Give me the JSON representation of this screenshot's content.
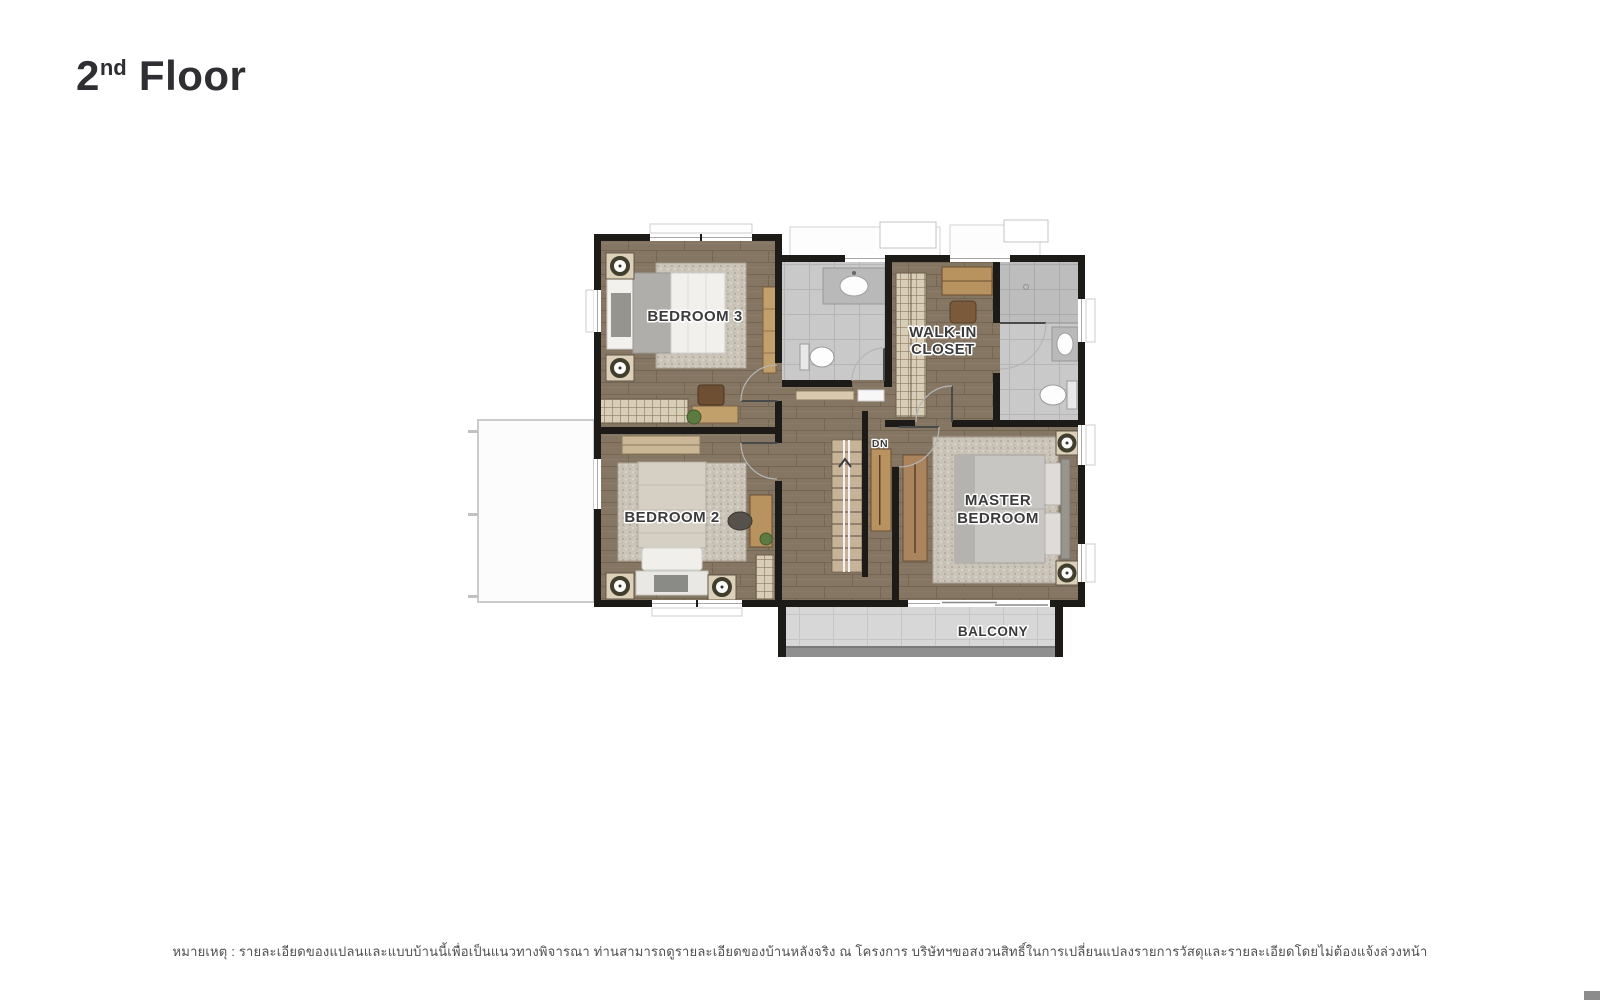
{
  "title": {
    "number": "2",
    "ordinal": "nd",
    "word": "Floor"
  },
  "disclaimer": "หมายเหตุ : รายละเอียดของแปลนและแบบบ้านนี้เพื่อเป็นแนวทางพิจารณา ท่านสามารถดูรายละเอียดของบ้านหลังจริง ณ โครงการ บริษัทฯขอสงวนสิทธิ์ในการเปลี่ยนแปลงรายการวัสดุและรายละเอียดโดยไม่ต้องแจ้งล่วงหน้า",
  "plan": {
    "labels": {
      "bedroom3": "BEDROOM 3",
      "bedroom2": "BEDROOM 2",
      "walk_in_line1": "WALK-IN",
      "walk_in_line2": "CLOSET",
      "master_line1": "MASTER",
      "master_line2": "BEDROOM",
      "balcony": "BALCONY",
      "stairs_down": "DN"
    },
    "colors": {
      "wall": "#1d1b18",
      "wood_floor": "#857664",
      "bathroom_tile": "#c9c9c9",
      "balcony_tile": "#d7d7d7",
      "rug": "#cac4b9",
      "furniture_wood": "#b9935f",
      "label_text": "#3b3b3b",
      "railing_gray": "#8f8f8f"
    }
  },
  "corner_mark_color": "#8c8c8c"
}
